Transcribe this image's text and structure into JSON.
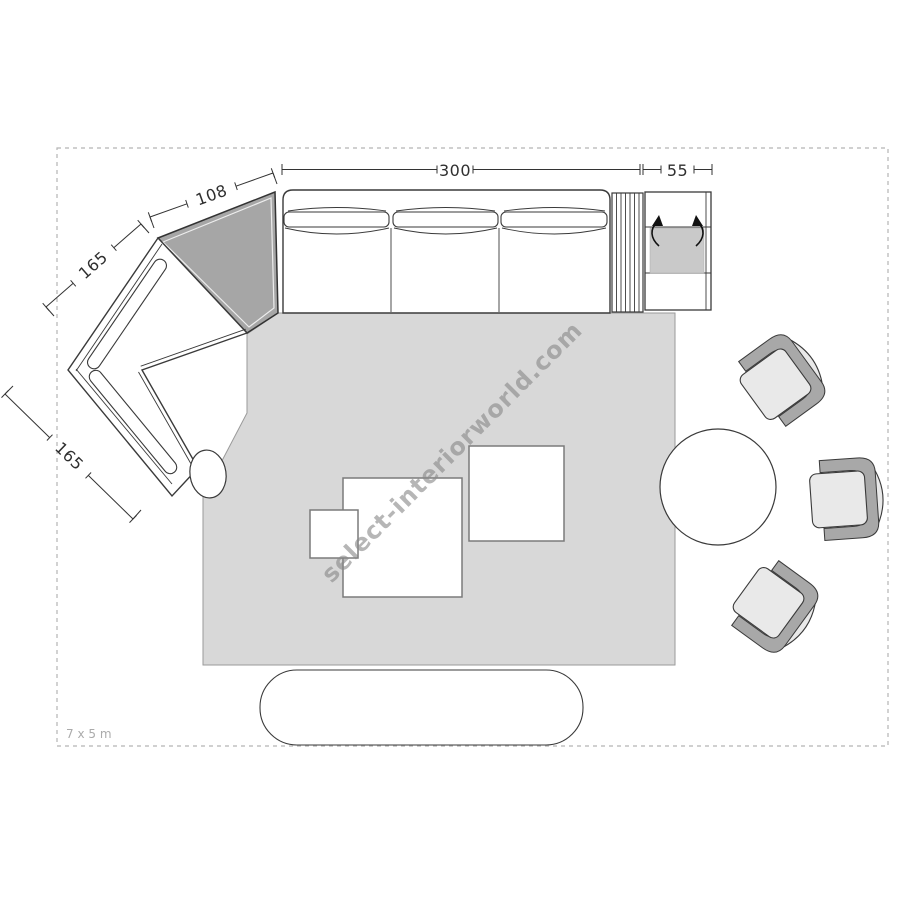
{
  "title": "Living room furniture floor plan",
  "room": {
    "area_label": "7 x 5 m"
  },
  "watermark": {
    "text": "select-interiorworld.com"
  },
  "dimensions": {
    "sofa_width": "300",
    "side_unit_width": "55",
    "corner_module_width": "108",
    "left_module_upper": "165",
    "left_module_lower": "165"
  },
  "furniture": {
    "sofa": "three-seat sofa",
    "corner_module": "corner element",
    "chaise": "angled two-seat module",
    "slatted_table": "slatted side table",
    "storage_unit": "flip-top storage unit",
    "coffee_tables": [
      "large square table",
      "small square table",
      "square side table"
    ],
    "round_table": "round table",
    "armchairs": 3,
    "bench": "oval bench",
    "side_table_oval": "small oval table"
  },
  "colors": {
    "rug": "#d8d8d8",
    "corner_module_fill": "#a6a6a6",
    "chair_band": "#a8a8a8",
    "chair_seat": "#e9e9e9",
    "unit_inner_panel": "#c9c9c9",
    "outline": "#3a3a3a",
    "dashed_border": "#b5b5b5",
    "dimension_text": "#2f2f2f",
    "watermark": "#8a8a8a",
    "area_label": "#ababab"
  }
}
